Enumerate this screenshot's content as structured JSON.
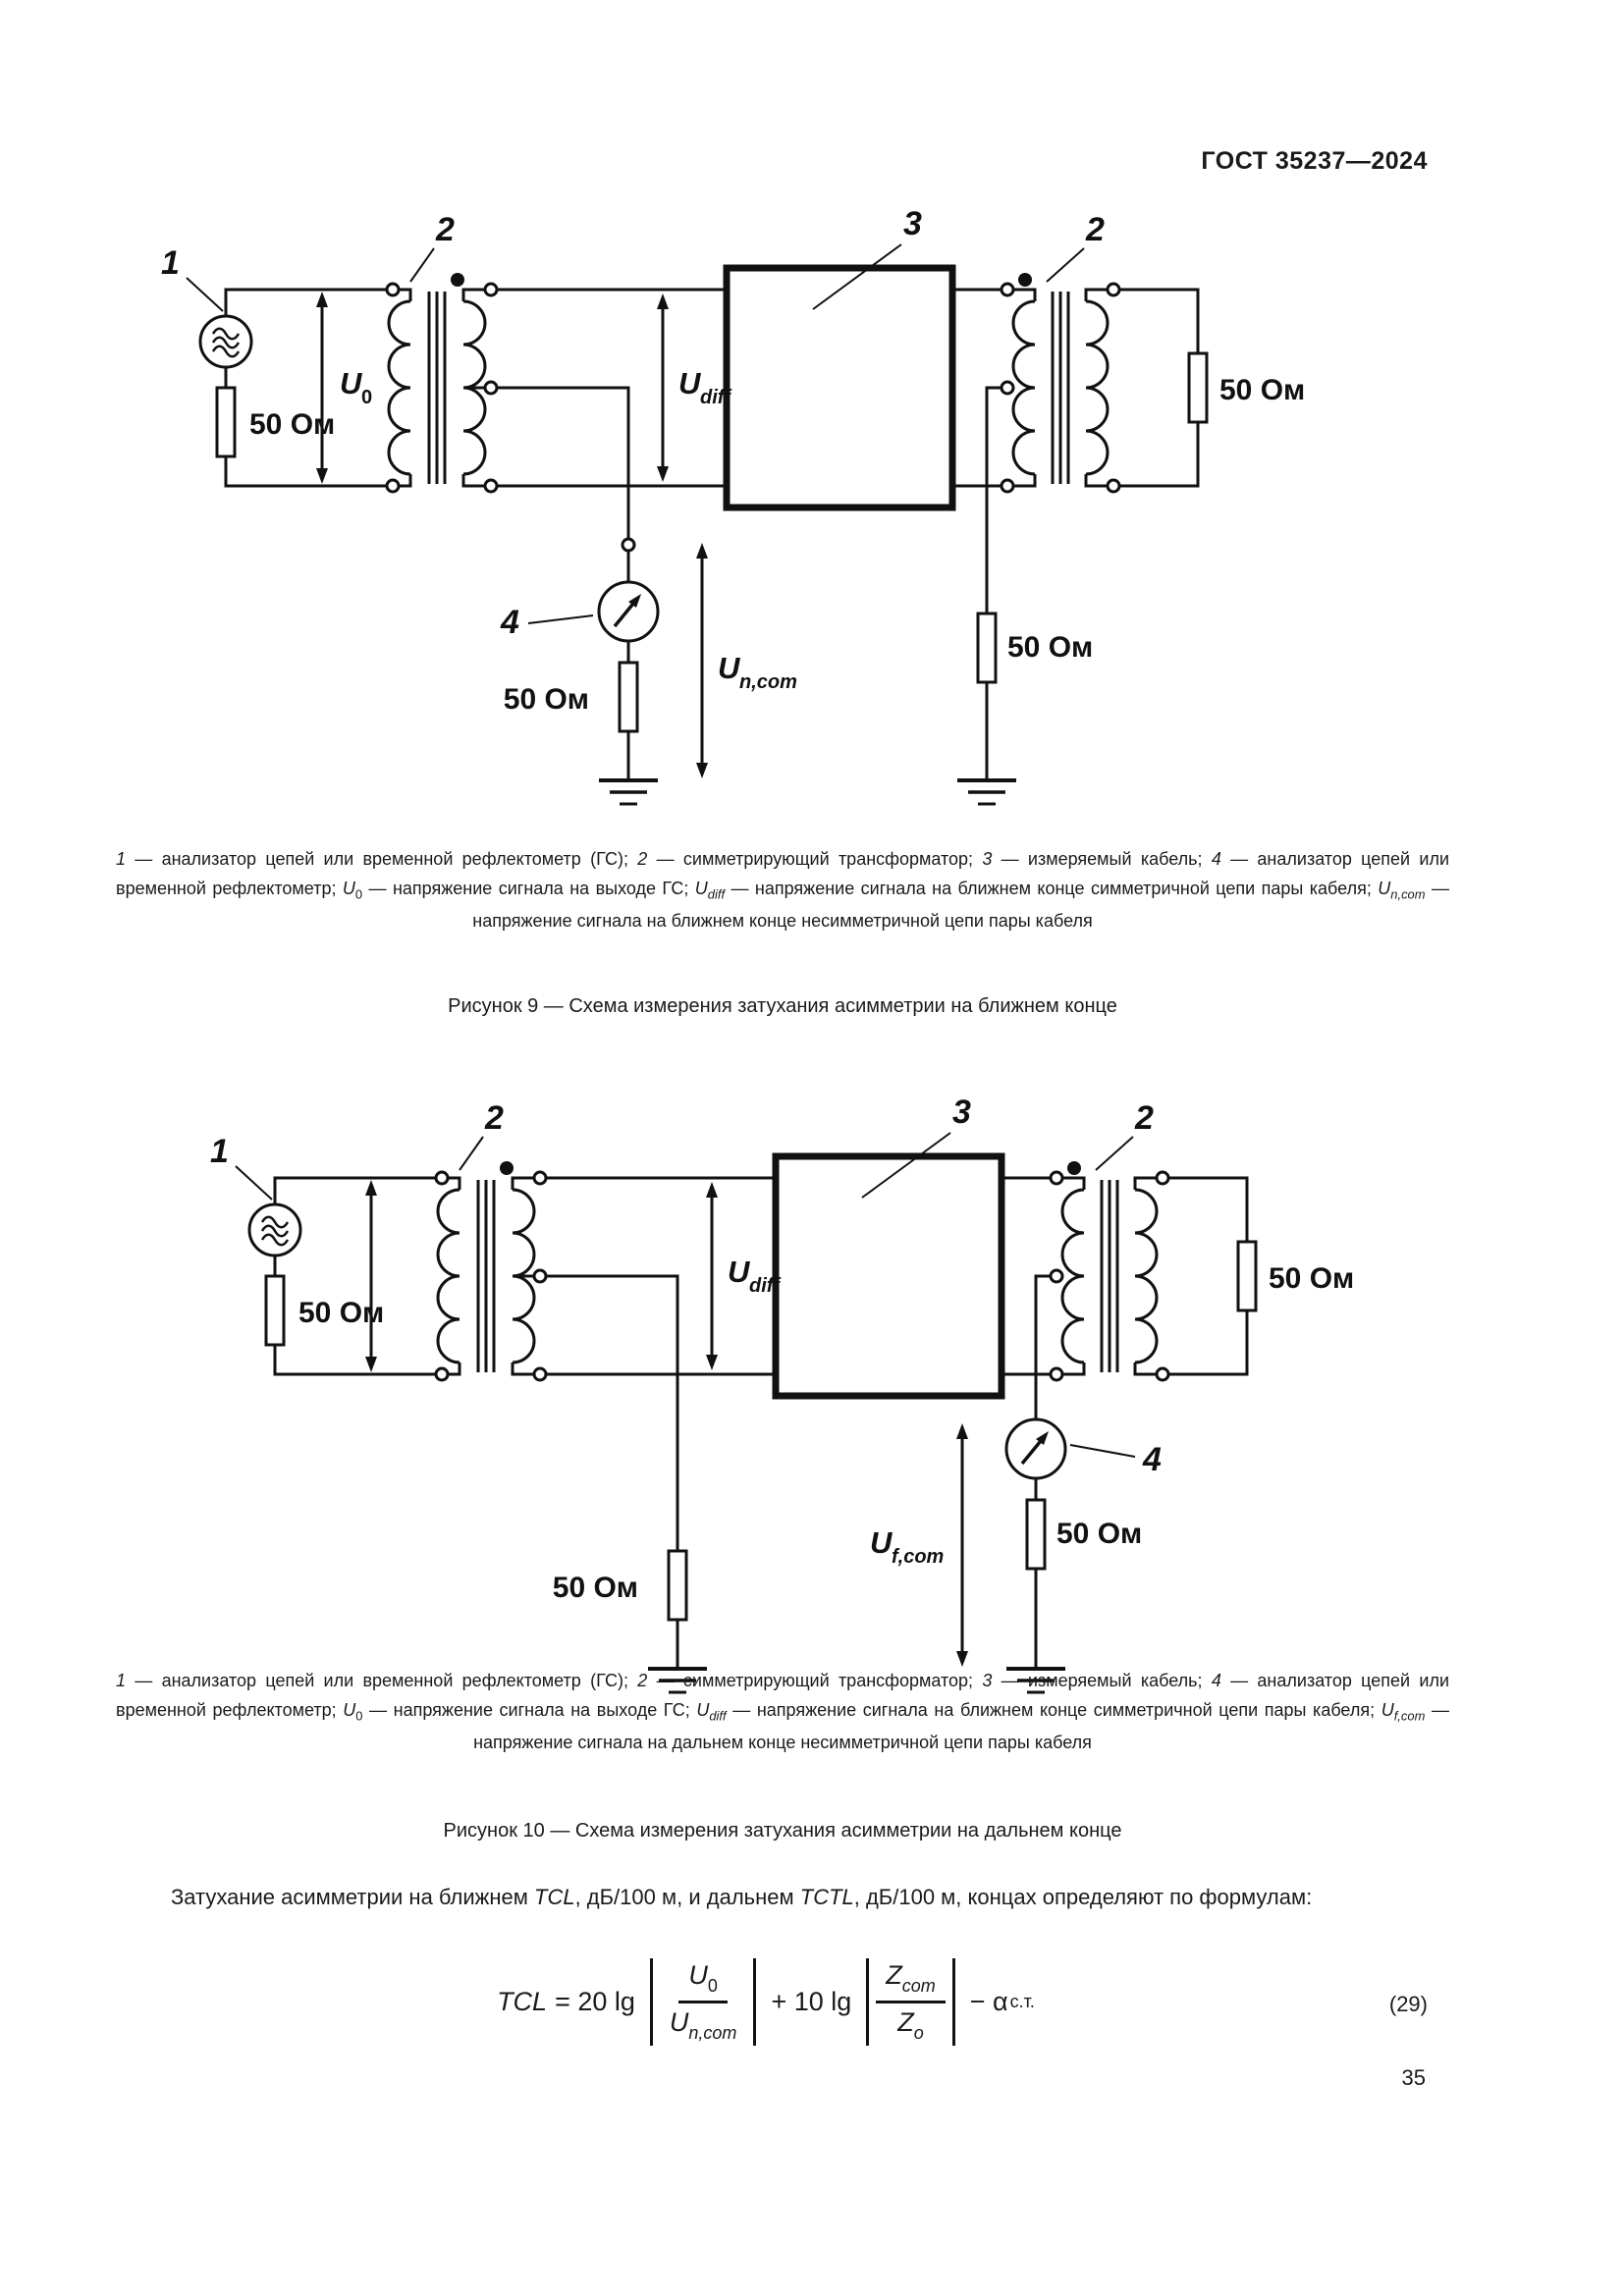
{
  "header": "ГОСТ 35237—2024",
  "page_number": "35",
  "fig9": {
    "callout_1": "1",
    "callout_2_left": "2",
    "callout_3": "3",
    "callout_2_right": "2",
    "callout_4": "4",
    "source_resistor_label": "50 Ом",
    "meter_resistor_label": "50 Ом",
    "mid_resistor_label": "50 Ом",
    "load_resistor_label": "50 Ом",
    "u0_main": "U",
    "u0_sub": "0",
    "udiff_main": "U",
    "udiff_sub": "diff",
    "uncom_main": "U",
    "uncom_sub": "n,com",
    "caption": [
      {
        "t": "1",
        "i": true
      },
      {
        "t": " — анализатор цепей или временной рефлектометр (ГС); "
      },
      {
        "t": "2",
        "i": true
      },
      {
        "t": " — симметрирующий трансформатор; "
      },
      {
        "t": "3",
        "i": true
      },
      {
        "t": " — измеряемый кабель; "
      },
      {
        "t": "4",
        "i": true
      },
      {
        "t": " — анализатор цепей или временной рефлектометр; "
      },
      {
        "t": "U",
        "i": true
      },
      {
        "t": "0",
        "sub": true
      },
      {
        "t": " — напряжение сигнала на выходе ГС; "
      },
      {
        "t": "U",
        "i": true
      },
      {
        "t": "diff",
        "sub": true,
        "i": true
      },
      {
        "t": " — напряжение сигнала на ближнем конце симметричной цепи пары кабеля; "
      },
      {
        "t": "U",
        "i": true
      },
      {
        "t": "n,com",
        "sub": true,
        "i": true
      },
      {
        "t": " — напряжение сигнала на ближнем конце несимметричной цепи пары кабеля"
      }
    ],
    "title": "Рисунок 9 — Схема измерения затухания асимметрии на ближнем конце"
  },
  "fig10": {
    "callout_1": "1",
    "callout_2_left": "2",
    "callout_3": "3",
    "callout_2_right": "2",
    "callout_4": "4",
    "source_resistor_label": "50 Ом",
    "left_resistor_label": "50 Ом",
    "meter_resistor_label": "50 Ом",
    "load_resistor_label": "50 Ом",
    "udiff_main": "U",
    "udiff_sub": "diff",
    "ufcom_main": "U",
    "ufcom_sub": "f,com",
    "caption": [
      {
        "t": "1",
        "i": true
      },
      {
        "t": " — анализатор цепей или временной рефлектометр (ГС); "
      },
      {
        "t": "2",
        "i": true
      },
      {
        "t": " — симметрирующий трансформатор; "
      },
      {
        "t": "3",
        "i": true
      },
      {
        "t": " — измеряемый кабель; "
      },
      {
        "t": "4",
        "i": true
      },
      {
        "t": " — анализатор цепей или временной рефлектометр; "
      },
      {
        "t": "U",
        "i": true
      },
      {
        "t": "0",
        "sub": true
      },
      {
        "t": " — напряжение сигнала на выходе ГС; "
      },
      {
        "t": "U",
        "i": true
      },
      {
        "t": "diff",
        "sub": true,
        "i": true
      },
      {
        "t": " — напряжение сигнала на ближнем конце симметричной цепи пары кабеля; "
      },
      {
        "t": "U",
        "i": true
      },
      {
        "t": "f,com",
        "sub": true,
        "i": true
      },
      {
        "t": " — напряжение сигнала на дальнем конце несимметричной цепи пары кабеля"
      }
    ],
    "title": "Рисунок 10 — Схема измерения затухания асимметрии на дальнем конце"
  },
  "paragraph": [
    {
      "t": "Затухание асимметрии на ближнем "
    },
    {
      "t": "TCL",
      "i": true
    },
    {
      "t": ", дБ/100 м, и дальнем "
    },
    {
      "t": "TCTL",
      "i": true
    },
    {
      "t": ", дБ/100 м, концах определяют по формулам:"
    }
  ],
  "formula": {
    "lhs": "TCL",
    "op1": "= 20 lg",
    "num1_main": "U",
    "num1_sub": "0",
    "den1_main": "U",
    "den1_sub": "n,com",
    "op2": "+ 10 lg",
    "num2_main": "Z",
    "num2_sub": "com",
    "den2_main": "Z",
    "den2_sub": "o",
    "op3": "− α",
    "op3_sub": "с.т.",
    "number": "(29)"
  },
  "colors": {
    "ink": "#111111",
    "paper": "#ffffff"
  }
}
